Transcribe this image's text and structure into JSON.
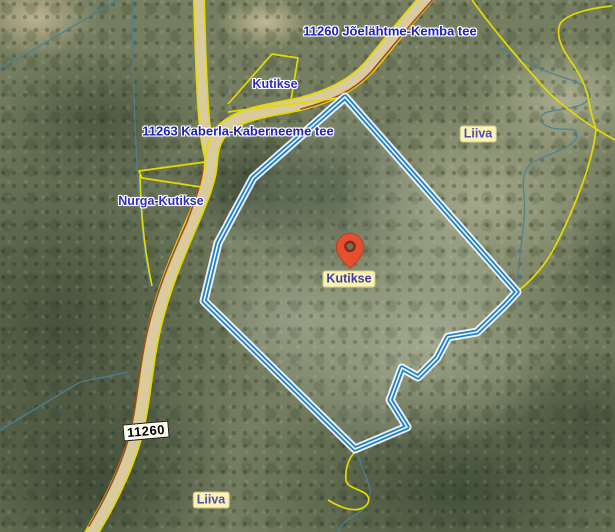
{
  "map": {
    "labels": {
      "road_top": "11260 Jõelähtme-Kemba tee",
      "road_11263": "11263 Kaberla-Kaberneeme tee",
      "kutikse_north": "Kutikse",
      "liiva_east": "Liiva",
      "nurga_kutikse": "Nurga-Kutikse",
      "marker": "Kutikse",
      "shield": "11260",
      "liiva_south": "Liiva"
    },
    "colors": {
      "marker_pin": "#e4502e",
      "parcel_outline": "#2180cc",
      "cadastral_line": "#e4da00",
      "road_fill": "#d9cb9e",
      "road_side_line": "#a04a28",
      "road_label_text": "#2222b8",
      "place_chip_bg": "#fbf3ae",
      "place_chip_text": "#4d4dbb",
      "stream": "#4a8196"
    }
  }
}
